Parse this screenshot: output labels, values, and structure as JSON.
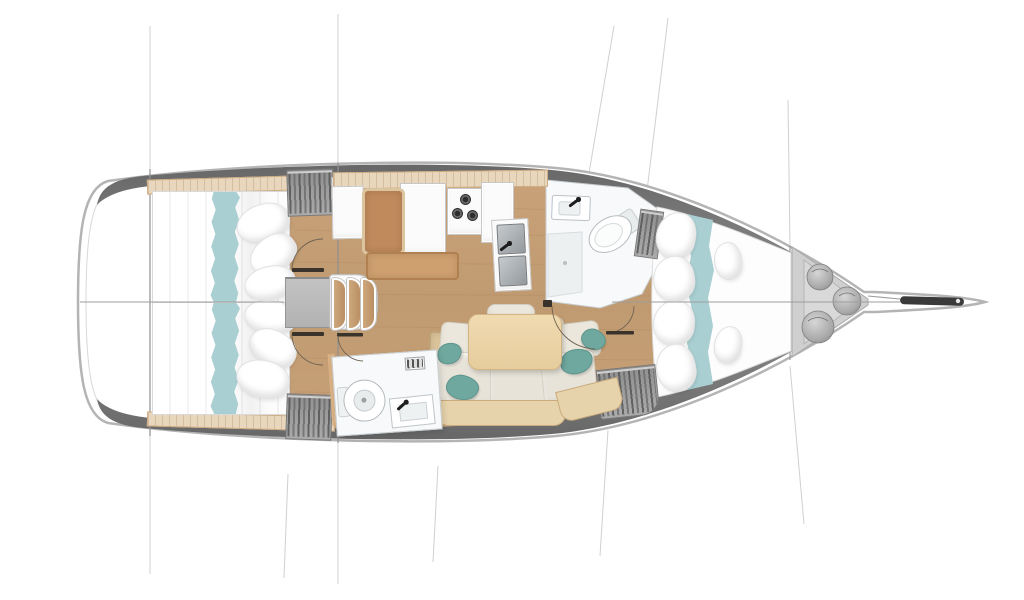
{
  "page": {
    "title": "Sailing yacht interior layout — top-down floor plan"
  },
  "palette": {
    "hull_outline": "#b4b4b4",
    "deck_dark": "#5e5e5e",
    "deck_light": "#8d8d8d",
    "floor_wood": "#c49d73",
    "floor_wood_dark": "#b78f66",
    "trim_wood": "#e8d7bd",
    "accent_teal": "#a9cfd2",
    "pillow_teal": "#6fa89f",
    "cushion_gray": "#ebe7dc",
    "furniture_tan": "#cfa06f",
    "nav_seat_brown": "#c08a5c",
    "wardrobe_gray": "#9e9e9e",
    "fixture_white": "#f7f9fa",
    "table_wood": "#ead2a7",
    "steel": "#a8adb2",
    "line_gray": "#9d9d9d",
    "anchor_dark": "#3a3a3a",
    "locker_gray": "#cfcfcf"
  },
  "rooms": [
    {
      "id": "aft-cabin-port",
      "furniture": [
        "double-berth",
        "teal-runner",
        "pillows",
        "wardrobe",
        "locker"
      ]
    },
    {
      "id": "aft-cabin-starboard",
      "furniture": [
        "double-berth",
        "teal-runner",
        "pillows",
        "wardrobe",
        "locker"
      ]
    },
    {
      "id": "companionway",
      "furniture": [
        "landing-platform",
        "three-curved-steps"
      ]
    },
    {
      "id": "galley-nav",
      "furniture": [
        "nav-seat",
        "chart-table",
        "stove-3-burner",
        "counter",
        "double-sink",
        "bench"
      ]
    },
    {
      "id": "salon",
      "furniture": [
        "settee",
        "teal-pillows",
        "dining-table",
        "small-bench",
        "sofa-arm",
        "wood-base"
      ]
    },
    {
      "id": "head-forward",
      "furniture": [
        "washbasin",
        "toilet",
        "shower"
      ]
    },
    {
      "id": "head-aft",
      "furniture": [
        "toilet",
        "washbasin",
        "vent-badge"
      ]
    },
    {
      "id": "forward-cabin",
      "furniture": [
        "v-berth",
        "teal-runner",
        "pillows",
        "wardrobe",
        "hanging-locker"
      ]
    },
    {
      "id": "sail-locker",
      "furniture": [
        "fender-bag",
        "fender-bag",
        "fender-bag"
      ]
    },
    {
      "id": "bow",
      "furniture": [
        "bowsprit-anchor"
      ]
    }
  ],
  "counts": {
    "cabins": 3,
    "heads": 2,
    "wardrobes": 5,
    "fender_bags": 3,
    "stove_burners": 3
  }
}
